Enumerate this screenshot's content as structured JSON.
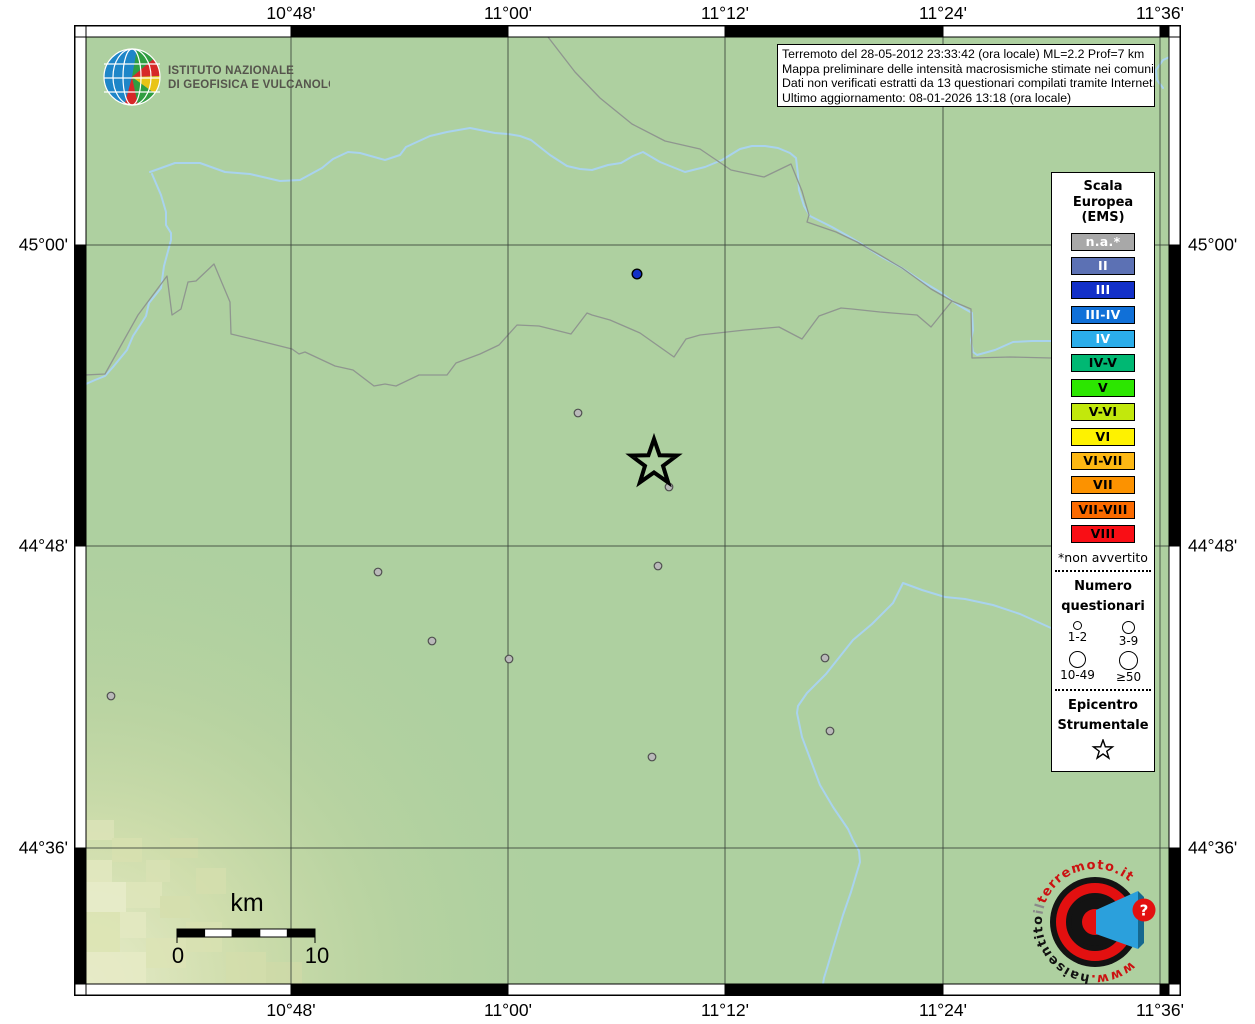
{
  "branding": {
    "ingv_line1": "ISTITUTO NAZIONALE",
    "ingv_line2": "DI GEOFISICA E VULCANOLOGIA"
  },
  "info_box": {
    "lines": [
      "Terremoto del 28-05-2012 23:33:42 (ora locale) ML=2.2 Prof=7 km",
      "Mappa preliminare delle intensità macrosismiche stimate nei comuni",
      "Dati non verificati estratti da 13 questionari compilati tramite Internet.",
      "Ultimo aggiornamento: 08-01-2026 13:18 (ora locale)"
    ]
  },
  "axes": {
    "top": [
      {
        "label": "10°48'",
        "x": 291
      },
      {
        "label": "11°00'",
        "x": 508
      },
      {
        "label": "11°12'",
        "x": 725
      },
      {
        "label": "11°24'",
        "x": 943
      },
      {
        "label": "11°36'",
        "x": 1160
      }
    ],
    "bottom": [
      {
        "label": "10°48'",
        "x": 291
      },
      {
        "label": "11°00'",
        "x": 508
      },
      {
        "label": "11°12'",
        "x": 725
      },
      {
        "label": "11°24'",
        "x": 943
      },
      {
        "label": "11°36'",
        "x": 1160
      }
    ],
    "left": [
      {
        "label": "45°00'",
        "y": 245
      },
      {
        "label": "44°48'",
        "y": 546
      },
      {
        "label": "44°36'",
        "y": 848
      }
    ],
    "right": [
      {
        "label": "45°00'",
        "y": 245
      },
      {
        "label": "44°48'",
        "y": 546
      },
      {
        "label": "44°36'",
        "y": 848
      }
    ]
  },
  "legend": {
    "title_lines": [
      "Scala",
      "Europea",
      "(EMS)"
    ],
    "ems_scale": [
      {
        "label": "n.a.*",
        "color": "#a8a8a8",
        "text": "#ffffff"
      },
      {
        "label": "II",
        "color": "#5c71b4",
        "text": "#ffffff"
      },
      {
        "label": "III",
        "color": "#1330c8",
        "text": "#ffffff"
      },
      {
        "label": "III-IV",
        "color": "#1070d8",
        "text": "#ffffff"
      },
      {
        "label": "IV",
        "color": "#2badea",
        "text": "#ffffff"
      },
      {
        "label": "IV-V",
        "color": "#00b873",
        "text": "#000000"
      },
      {
        "label": "V",
        "color": "#2ce600",
        "text": "#000000"
      },
      {
        "label": "V-VI",
        "color": "#c2e80c",
        "text": "#000000"
      },
      {
        "label": "VI",
        "color": "#fef200",
        "text": "#000000"
      },
      {
        "label": "VI-VII",
        "color": "#fdb813",
        "text": "#000000"
      },
      {
        "label": "VII",
        "color": "#fc9200",
        "text": "#000000"
      },
      {
        "label": "VII-VIII",
        "color": "#fb6a00",
        "text": "#000000"
      },
      {
        "label": "VIII",
        "color": "#f90e15",
        "text": "#000000"
      }
    ],
    "footnote": "*non avvertito",
    "questionnaires": {
      "title_lines": [
        "Numero",
        "questionari"
      ],
      "sizes": [
        {
          "label": "1-2",
          "d": 9
        },
        {
          "label": "3-9",
          "d": 13
        },
        {
          "label": "10-49",
          "d": 17
        },
        {
          "label": "≥50",
          "d": 19
        }
      ]
    },
    "epicenter_title_lines": [
      "Epicentro",
      "Strumentale"
    ]
  },
  "scalebar": {
    "unit": "km",
    "start": "0",
    "end": "10"
  },
  "map_data": {
    "epicenter": {
      "x": 654,
      "y": 463
    },
    "intensity_points": [
      {
        "x": 637,
        "y": 274,
        "ems": "III",
        "color": "#1330c8"
      }
    ],
    "questionnaire_points": [
      [
        578,
        413
      ],
      [
        669,
        487
      ],
      [
        378,
        572
      ],
      [
        658,
        566
      ],
      [
        432,
        641
      ],
      [
        509,
        659
      ],
      [
        825,
        658
      ],
      [
        111,
        696
      ],
      [
        830,
        731
      ],
      [
        652,
        757
      ]
    ]
  },
  "watermark": {
    "www": "www.",
    "hai": "haisentito",
    "il": "il",
    "domain": "terremoto.it",
    "question": "?"
  },
  "colors": {
    "land": "#aed0a0",
    "river": "#a9d3ee",
    "boundary": "#8f968f",
    "grid": "#3a433a"
  }
}
